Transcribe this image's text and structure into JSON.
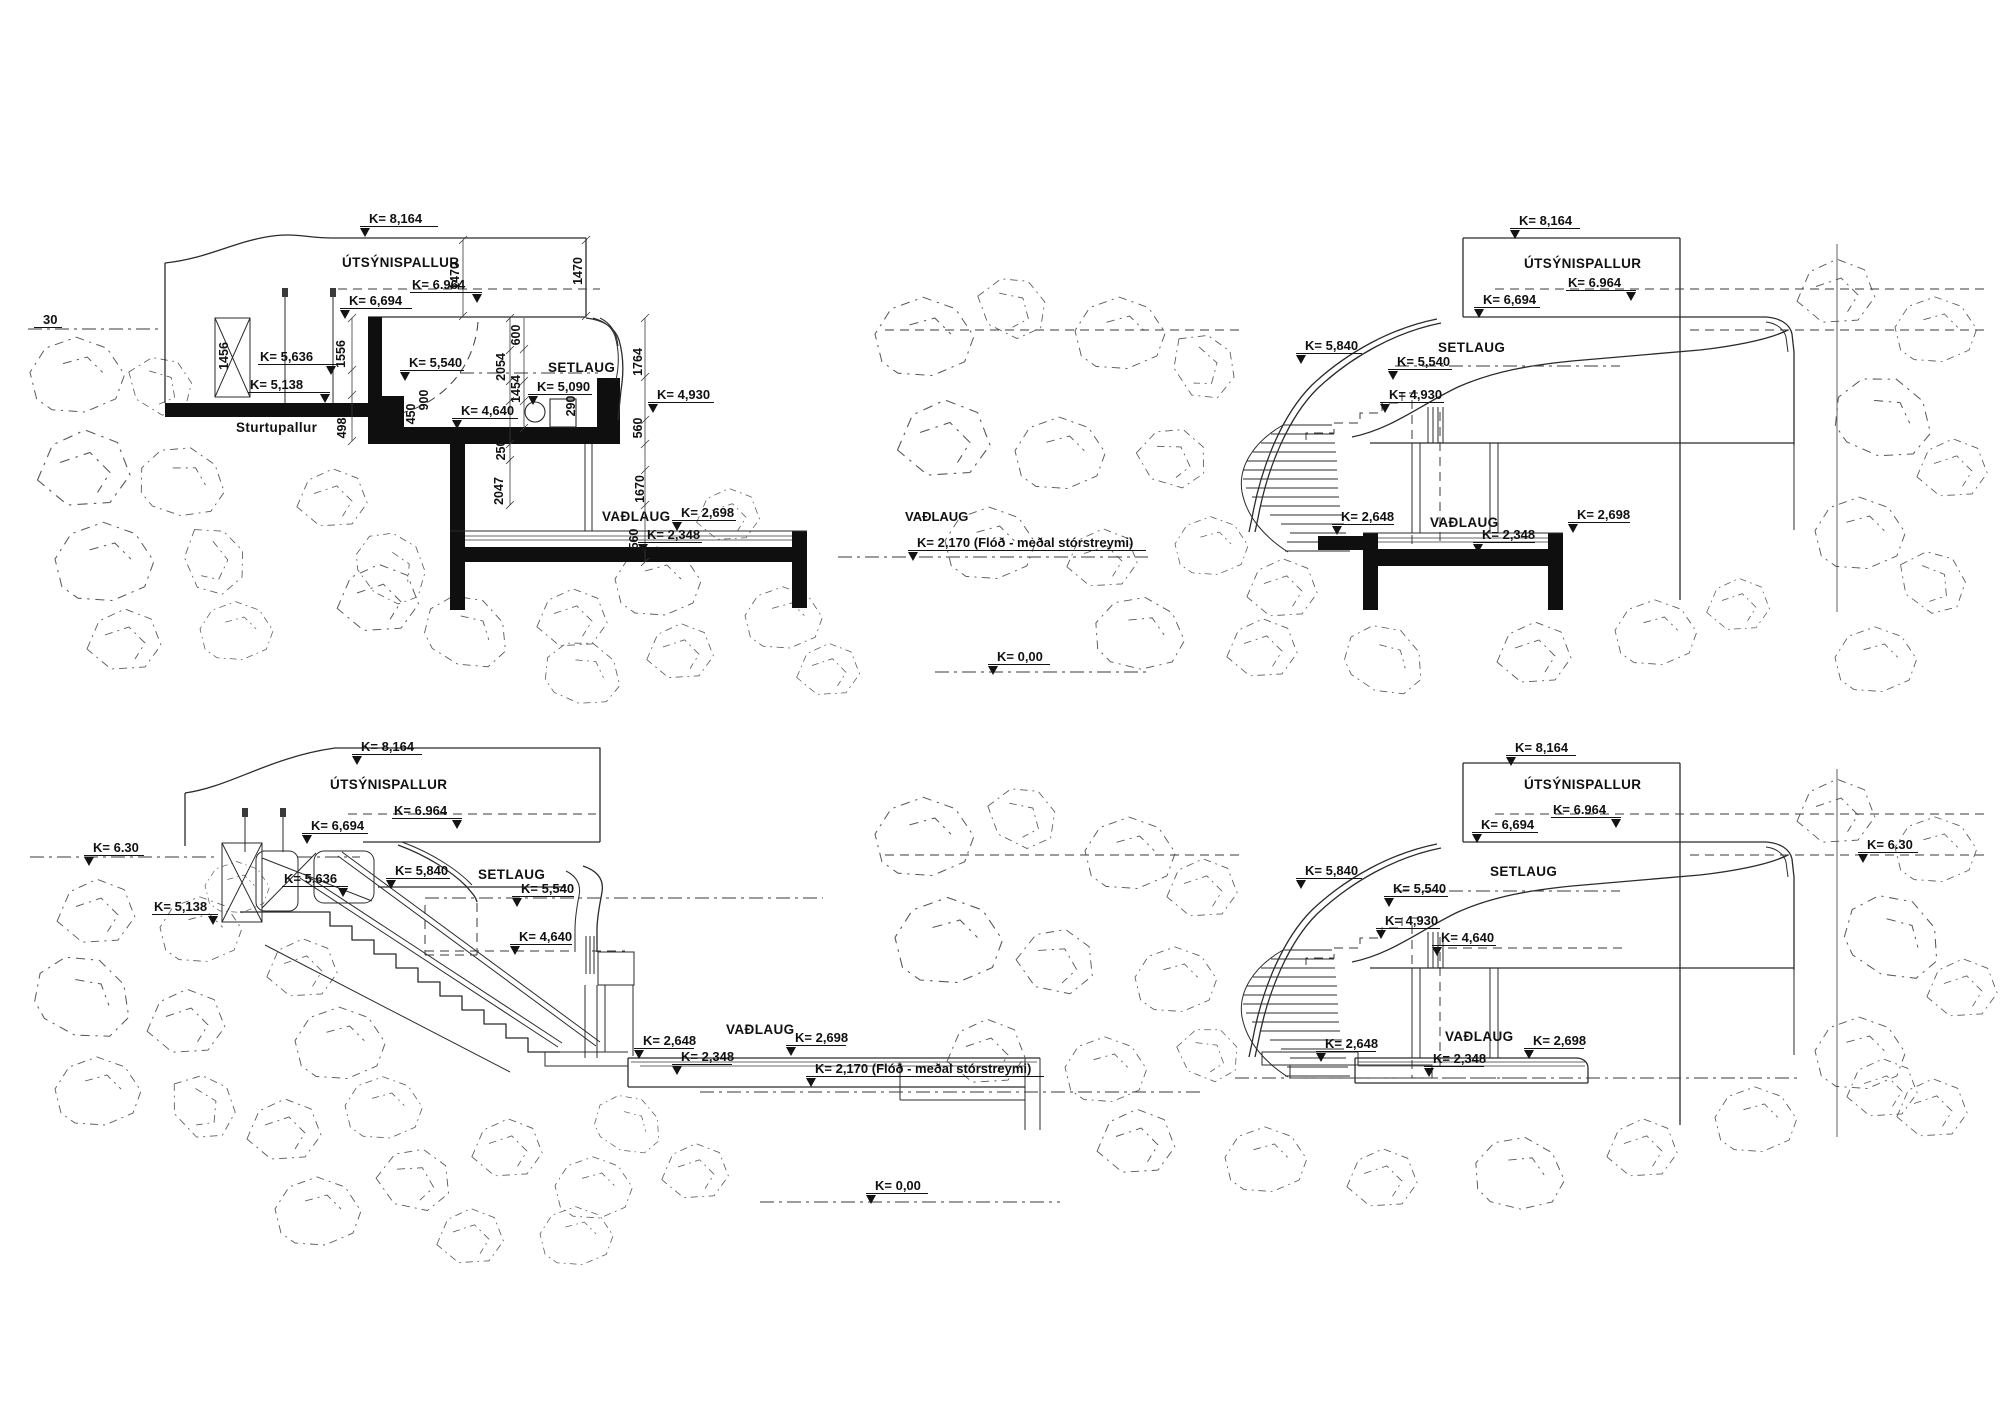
{
  "drawing": {
    "background": "#ffffff",
    "ink_color": "#2b2b2b",
    "black_fill": "#0f0f0f",
    "sections": [
      {
        "id": "section-top-left",
        "levels": [
          {
            "text": "K= 8,164",
            "x": 360,
            "y": 212,
            "lw": 78,
            "m": "l"
          },
          {
            "text": "K= 6.964",
            "x": 410,
            "y": 278,
            "lw": 72,
            "m": "r"
          },
          {
            "text": "K= 6,694",
            "x": 340,
            "y": 294,
            "lw": 72,
            "m": "l"
          },
          {
            "text": "K= 5,636",
            "x": 258,
            "y": 350,
            "lw": 78,
            "m": "r"
          },
          {
            "text": "K= 5,138",
            "x": 248,
            "y": 378,
            "lw": 82,
            "m": "r"
          },
          {
            "text": "K= 5,540",
            "x": 400,
            "y": 356,
            "lw": 64,
            "m": "l"
          },
          {
            "text": "K= 5,090",
            "x": 528,
            "y": 380,
            "lw": 64,
            "m": "l"
          },
          {
            "text": "K= 4,930",
            "x": 648,
            "y": 388,
            "lw": 66,
            "m": "l"
          },
          {
            "text": "K= 4,640",
            "x": 452,
            "y": 404,
            "lw": 66,
            "m": "l"
          },
          {
            "text": "K= 2,698",
            "x": 672,
            "y": 506,
            "lw": 64,
            "m": "l"
          },
          {
            "text": "K= 2,348",
            "x": 638,
            "y": 528,
            "lw": 64,
            "m": "l"
          },
          {
            "text": "30",
            "x": 34,
            "y": 313,
            "lw": 28,
            "m": "n"
          },
          {
            "text": "VAÐLAUG",
            "x": 896,
            "y": 510,
            "lw": 0,
            "m": "t"
          },
          {
            "text": "K= 2,170 (Flóð - meðal stórstreymi)",
            "x": 908,
            "y": 536,
            "lw": 238,
            "m": "l"
          },
          {
            "text": "K= 0,00",
            "x": 988,
            "y": 650,
            "lw": 62,
            "m": "l"
          }
        ],
        "areas": [
          {
            "text": "ÚTSÝNISPALLUR",
            "x": 342,
            "y": 255
          },
          {
            "text": "SETLAUG",
            "x": 548,
            "y": 360
          },
          {
            "text": "Sturtupallur",
            "x": 236,
            "y": 420
          },
          {
            "text": "VAÐLAUG",
            "x": 602,
            "y": 509
          }
        ],
        "dims": [
          {
            "text": "1470",
            "x": 455,
            "y": 276
          },
          {
            "text": "1470",
            "x": 578,
            "y": 271
          },
          {
            "text": "1456",
            "x": 224,
            "y": 356
          },
          {
            "text": "1556",
            "x": 341,
            "y": 354
          },
          {
            "text": "600",
            "x": 516,
            "y": 335
          },
          {
            "text": "2054",
            "x": 501,
            "y": 367
          },
          {
            "text": "1454",
            "x": 516,
            "y": 389
          },
          {
            "text": "900",
            "x": 424,
            "y": 400
          },
          {
            "text": "450",
            "x": 411,
            "y": 414
          },
          {
            "text": "290",
            "x": 571,
            "y": 406
          },
          {
            "text": "1764",
            "x": 638,
            "y": 362
          },
          {
            "text": "560",
            "x": 638,
            "y": 428
          },
          {
            "text": "498",
            "x": 342,
            "y": 428
          },
          {
            "text": "250",
            "x": 501,
            "y": 450
          },
          {
            "text": "2047",
            "x": 499,
            "y": 491
          },
          {
            "text": "1670",
            "x": 640,
            "y": 489
          },
          {
            "text": "560",
            "x": 634,
            "y": 539
          }
        ]
      },
      {
        "id": "section-top-right",
        "levels": [
          {
            "text": "K= 8,164",
            "x": 1510,
            "y": 214,
            "lw": 70,
            "m": "l"
          },
          {
            "text": "K= 6.964",
            "x": 1566,
            "y": 276,
            "lw": 70,
            "m": "r"
          },
          {
            "text": "K= 6,694",
            "x": 1474,
            "y": 293,
            "lw": 66,
            "m": "l"
          },
          {
            "text": "K= 5,840",
            "x": 1296,
            "y": 339,
            "lw": 66,
            "m": "l"
          },
          {
            "text": "K= 5,540",
            "x": 1388,
            "y": 355,
            "lw": 64,
            "m": "l"
          },
          {
            "text": "K= 4,930",
            "x": 1380,
            "y": 388,
            "lw": 64,
            "m": "l"
          },
          {
            "text": "K= 2,648",
            "x": 1332,
            "y": 510,
            "lw": 62,
            "m": "l"
          },
          {
            "text": "K= 2,348",
            "x": 1473,
            "y": 528,
            "lw": 62,
            "m": "l"
          },
          {
            "text": "K= 2,698",
            "x": 1568,
            "y": 508,
            "lw": 62,
            "m": "l"
          }
        ],
        "areas": [
          {
            "text": "ÚTSÝNISPALLUR",
            "x": 1524,
            "y": 256
          },
          {
            "text": "SETLAUG",
            "x": 1438,
            "y": 340
          },
          {
            "text": "VAÐLAUG",
            "x": 1430,
            "y": 515
          }
        ],
        "dims": []
      },
      {
        "id": "section-bottom-left",
        "levels": [
          {
            "text": "K= 8,164",
            "x": 352,
            "y": 740,
            "lw": 70,
            "m": "l"
          },
          {
            "text": "K= 6.964",
            "x": 392,
            "y": 804,
            "lw": 70,
            "m": "r"
          },
          {
            "text": "K= 6,694",
            "x": 302,
            "y": 819,
            "lw": 66,
            "m": "l"
          },
          {
            "text": "K= 6.30",
            "x": 84,
            "y": 841,
            "lw": 60,
            "m": "l"
          },
          {
            "text": "K= 5,636",
            "x": 282,
            "y": 872,
            "lw": 66,
            "m": "r"
          },
          {
            "text": "K= 5,840",
            "x": 386,
            "y": 864,
            "lw": 64,
            "m": "l"
          },
          {
            "text": "K= 5,540",
            "x": 512,
            "y": 882,
            "lw": 62,
            "m": "l"
          },
          {
            "text": "K= 5,138",
            "x": 152,
            "y": 900,
            "lw": 66,
            "m": "r"
          },
          {
            "text": "K= 4,640",
            "x": 510,
            "y": 930,
            "lw": 62,
            "m": "l"
          },
          {
            "text": "K= 2,648",
            "x": 634,
            "y": 1034,
            "lw": 60,
            "m": "l"
          },
          {
            "text": "K= 2,698",
            "x": 786,
            "y": 1031,
            "lw": 60,
            "m": "l"
          },
          {
            "text": "K= 2,348",
            "x": 672,
            "y": 1050,
            "lw": 60,
            "m": "l"
          },
          {
            "text": "K= 2,170 (Flóð - meðal stórstreymi)",
            "x": 806,
            "y": 1062,
            "lw": 238,
            "m": "l"
          },
          {
            "text": "K= 0,00",
            "x": 866,
            "y": 1179,
            "lw": 62,
            "m": "l"
          }
        ],
        "areas": [
          {
            "text": "ÚTSÝNISPALLUR",
            "x": 330,
            "y": 777
          },
          {
            "text": "SETLAUG",
            "x": 478,
            "y": 867
          },
          {
            "text": "VAÐLAUG",
            "x": 726,
            "y": 1022
          }
        ],
        "dims": []
      },
      {
        "id": "section-bottom-right",
        "levels": [
          {
            "text": "K= 8,164",
            "x": 1506,
            "y": 741,
            "lw": 70,
            "m": "l"
          },
          {
            "text": "K= 6.964",
            "x": 1551,
            "y": 803,
            "lw": 70,
            "m": "r"
          },
          {
            "text": "K= 6,694",
            "x": 1472,
            "y": 818,
            "lw": 66,
            "m": "l"
          },
          {
            "text": "K= 6.30",
            "x": 1858,
            "y": 838,
            "lw": 60,
            "m": "l"
          },
          {
            "text": "K= 5,840",
            "x": 1296,
            "y": 864,
            "lw": 66,
            "m": "l"
          },
          {
            "text": "K= 5,540",
            "x": 1384,
            "y": 882,
            "lw": 64,
            "m": "l"
          },
          {
            "text": "K= 4,930",
            "x": 1376,
            "y": 914,
            "lw": 64,
            "m": "l"
          },
          {
            "text": "K= 4,640",
            "x": 1432,
            "y": 931,
            "lw": 64,
            "m": "l"
          },
          {
            "text": "K= 2,648",
            "x": 1316,
            "y": 1037,
            "lw": 60,
            "m": "l"
          },
          {
            "text": "K= 2,698",
            "x": 1524,
            "y": 1034,
            "lw": 60,
            "m": "l"
          },
          {
            "text": "K= 2,348",
            "x": 1424,
            "y": 1052,
            "lw": 60,
            "m": "l"
          }
        ],
        "areas": [
          {
            "text": "ÚTSÝNISPALLUR",
            "x": 1524,
            "y": 777
          },
          {
            "text": "SETLAUG",
            "x": 1490,
            "y": 864
          },
          {
            "text": "VAÐLAUG",
            "x": 1445,
            "y": 1029
          }
        ],
        "dims": []
      }
    ]
  }
}
